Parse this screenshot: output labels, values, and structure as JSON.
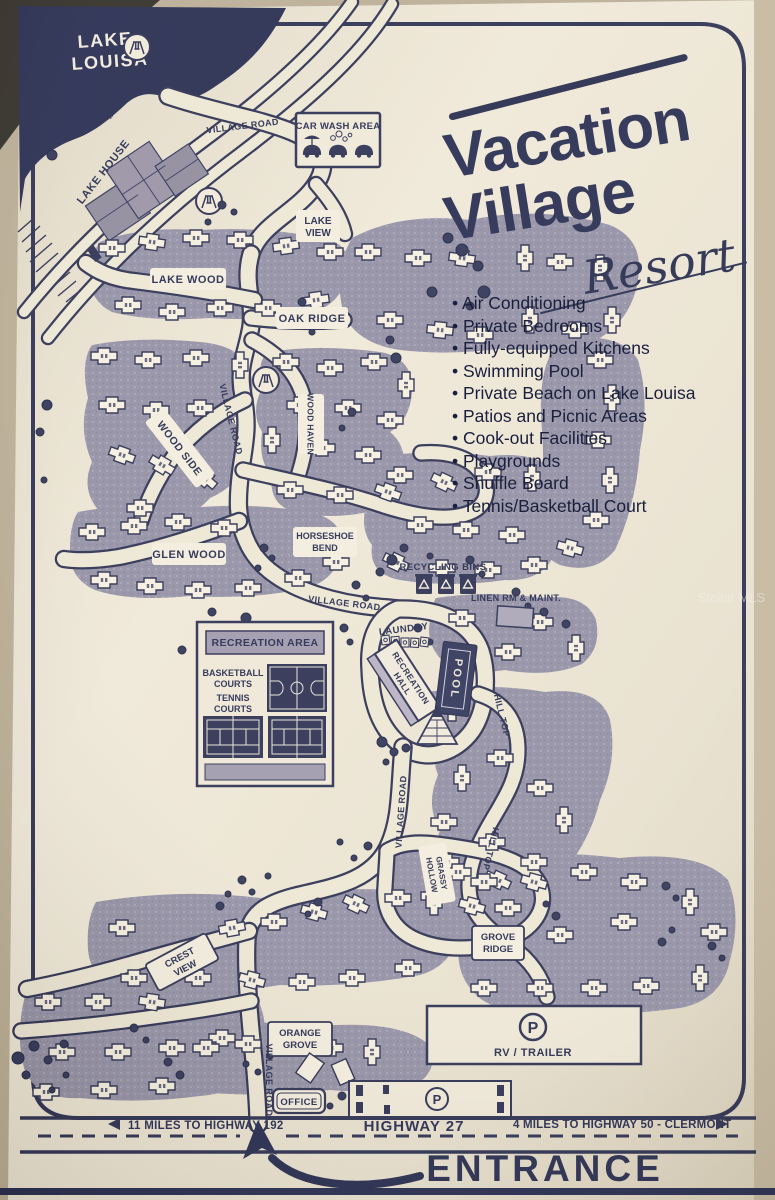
{
  "brand": {
    "word1": "Vacation",
    "word2": "Village",
    "script": "Resort"
  },
  "amenities": [
    "Air Conditioning",
    "Private Bedrooms",
    "Fully-equipped Kitchens",
    "Swimming Pool",
    "Private Beach on Lake Louisa",
    "Patios and Picnic Areas",
    "Cook-out Facilities",
    "Playgrounds",
    "Shuffle Board",
    "Tennis/Basketball Court"
  ],
  "lake": {
    "name": [
      "LAKE",
      "LOUISA"
    ]
  },
  "roads": {
    "village_road": "VILLAGE ROAD",
    "lake_louisa_road": "LAKE LOUISA ROAD",
    "private_beach": "VACATION VILLAGE PRIVATE BEACH",
    "lake_house": "LAKE HOUSE",
    "hill_top": "HILL TOP",
    "highway": "HIGHWAY 27"
  },
  "areas": {
    "lake_view": [
      "LAKE",
      "VIEW"
    ],
    "lake_wood": "LAKE WOOD",
    "oak_ridge": "OAK RIDGE",
    "wood_side": "WOOD SIDE",
    "wood_haven": "WOOD HAVEN",
    "glen_wood": "GLEN WOOD",
    "horseshoe_bend": [
      "HORSESHOE",
      "BEND"
    ],
    "grassy_hollow": [
      "GRASSY",
      "HOLLOW"
    ],
    "crest_view": [
      "CREST",
      "VIEW"
    ],
    "grove_ridge": [
      "GROVE",
      "RIDGE"
    ],
    "orange_grove": [
      "ORANGE",
      "GROVE"
    ]
  },
  "facilities": {
    "car_wash": "CAR WASH AREA",
    "recycling": "RECYCLING BINS",
    "linen": "LINEN RM & MAINT.",
    "laundry": "LAUNDRY",
    "recreation_hall": [
      "RECREATION",
      "HALL"
    ],
    "pool": "POOL",
    "recreation_area": "RECREATION AREA",
    "basketball": [
      "BASKETBALL",
      "COURTS"
    ],
    "tennis": [
      "TENNIS",
      "COURTS"
    ],
    "office": "OFFICE",
    "rv_trailer": "RV / TRAILER",
    "parking_p": "P"
  },
  "bottom": {
    "left_miles": "11 MILES TO HIGHWAY 192",
    "right_miles": "4 MILES TO HIGHWAY 50 - CLERMONT",
    "entrance": "ENTRANCE"
  },
  "watermark": "Stellar MLS",
  "colors": {
    "navy": "#232848",
    "cream": "#ece5d2",
    "mauve": "#8f8ba1",
    "photo": "#b9ab92"
  }
}
